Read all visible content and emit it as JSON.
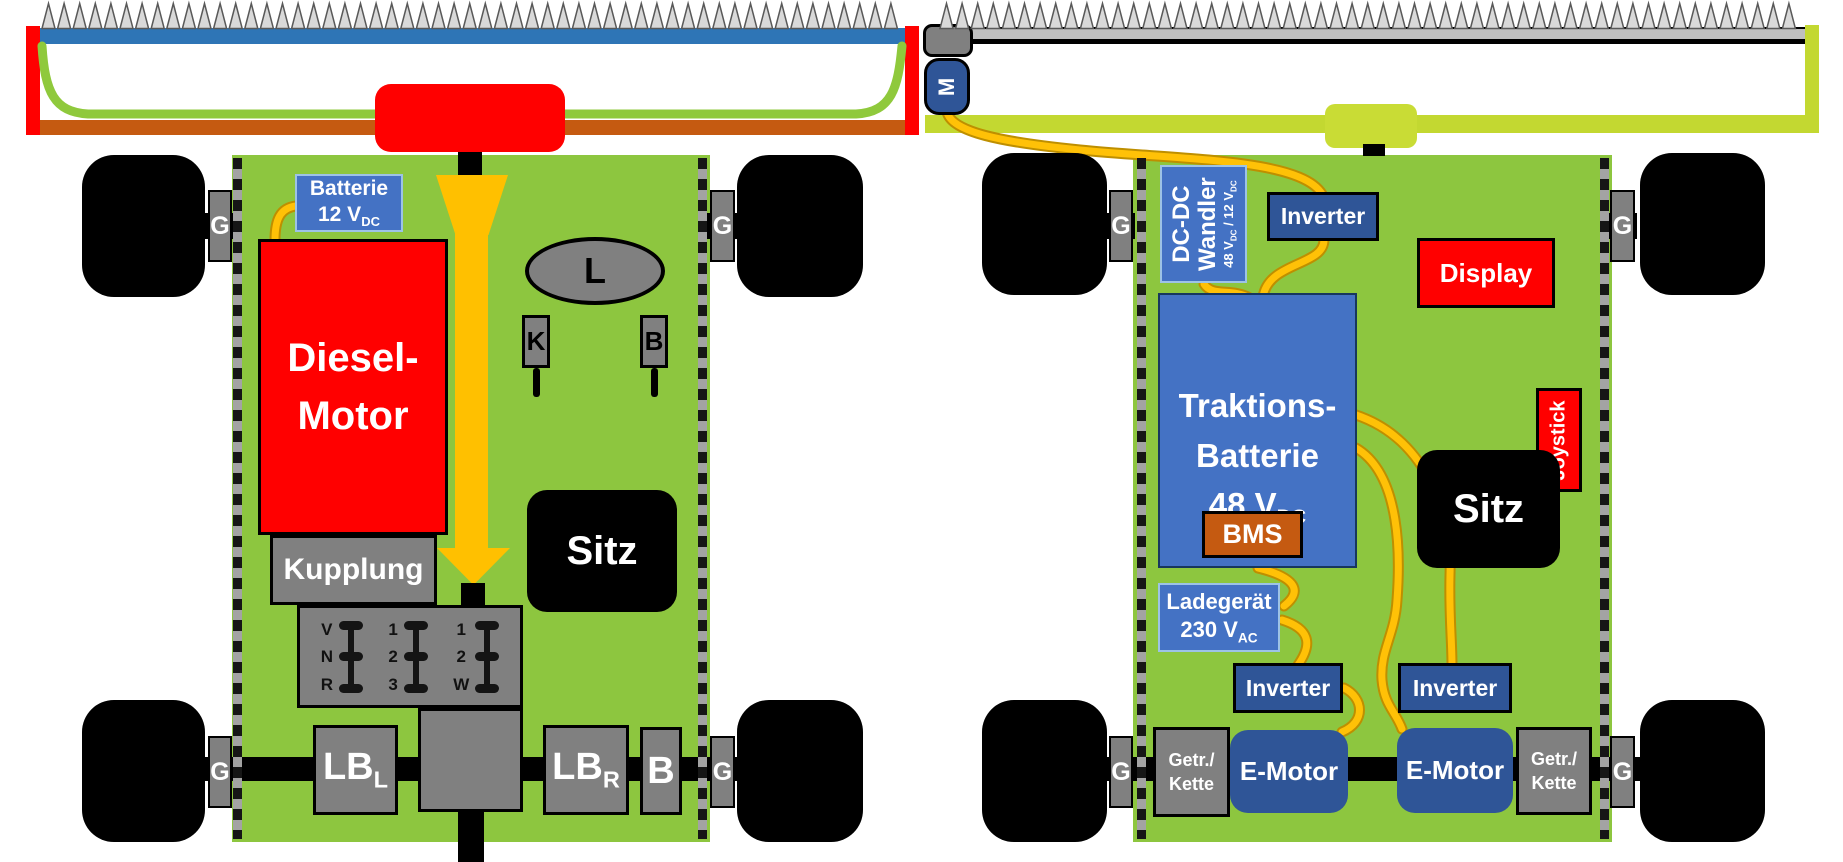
{
  "left_machine": {
    "battery": {
      "line1": "Batterie",
      "v": "12 V",
      "v_sub": "DC"
    },
    "engine_line1": "Diesel-",
    "engine_line2": "Motor",
    "clutch": "Kupplung",
    "gearbox_columns": [
      {
        "r1": "V",
        "r2": "N",
        "r3": "R"
      },
      {
        "r1": "1",
        "r2": "2",
        "r3": "3"
      },
      {
        "r1": "1",
        "r2": "2",
        "r3": "W"
      }
    ],
    "final_drive_left": {
      "main": "LB",
      "sub": "L"
    },
    "final_drive_right": {
      "main": "LB",
      "sub": "R"
    },
    "brake": "B",
    "seat": "Sitz",
    "steering_wheel": "L",
    "lever_k": "K",
    "lever_b": "B",
    "gearbox_g": "G"
  },
  "right_machine": {
    "cutter_motor": "M",
    "dcdc": {
      "line1": "DC-DC",
      "line2": "Wandler",
      "sub": {
        "p1": "48 V",
        "s1": "DC",
        "p2": " / 12 V",
        "s2": "DC"
      }
    },
    "inverter": "Inverter",
    "display": "Display",
    "battery": {
      "line1": "Traktions-",
      "line2": "Batterie",
      "v": "48 V",
      "v_sub": "DC"
    },
    "bms": "BMS",
    "charger": {
      "line1": "Ladegerät",
      "v": "230 V",
      "v_sub": "AC"
    },
    "seat": "Sitz",
    "joystick": "Joystick",
    "emotor": "E-Motor",
    "gear_chain": {
      "line1": "Getr./",
      "line2": "Kette"
    },
    "gearbox_g": "G"
  },
  "colors": {
    "body_green": "#8DC63F",
    "frame_red": "#FF0000",
    "cutterbar_blue": "#2E75B6",
    "cutterbar_gray": "#BFBFBF",
    "mower_deck_orange": "#C55A11",
    "belt_green": "#8FC93C",
    "lime_frame": "#C3D831",
    "cable_yellow": "#FFC000",
    "component_blue": "#4472C4",
    "component_darkblue": "#2F5597",
    "component_gray": "#808080",
    "bms_orange": "#C55A11"
  }
}
